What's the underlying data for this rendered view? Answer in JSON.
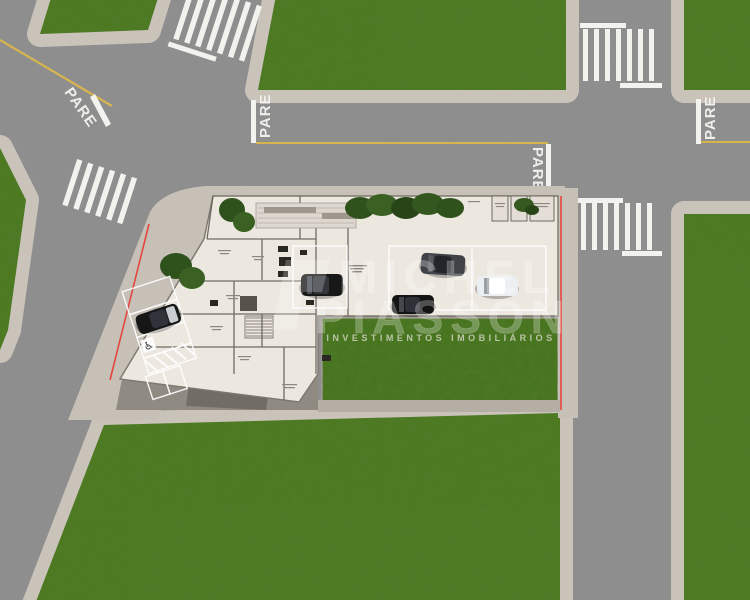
{
  "watermark": {
    "brand_line1": "MICHEL",
    "brand_line2": "PIASSON",
    "tagline": "INVESTIMENTOS IMOBILIÁRIOS"
  },
  "road_markings": {
    "stop_word": "PARE",
    "instances": [
      "northwest-approach",
      "center-road-west-stop",
      "center-road-east-stop",
      "east-road-stop"
    ]
  },
  "accessibility": {
    "disabled_parking_symbol": "♿"
  },
  "scene": {
    "type": "aerial-site-plan-render",
    "features": [
      "intersections",
      "crosswalks",
      "stop-markings",
      "l-shaped-building-floor-plan",
      "open-parking-lot",
      "street-parking",
      "lawns",
      "hedges",
      "parked-cars"
    ]
  },
  "colors": {
    "grass": "#4d7a22",
    "grass_dark": "#3c651a",
    "asphalt": "#8f8f8f",
    "sidewalk": "#c9c3ba",
    "building_slab": "#ece7df",
    "parking_slab": "#e6e0d8",
    "property_line_red": "#e5453f",
    "lane_line_yellow": "#d7b54e",
    "hedge_green": "#2f511c",
    "car_black": "#181818",
    "car_gray": "#3f4246",
    "car_white": "#eceff1"
  }
}
